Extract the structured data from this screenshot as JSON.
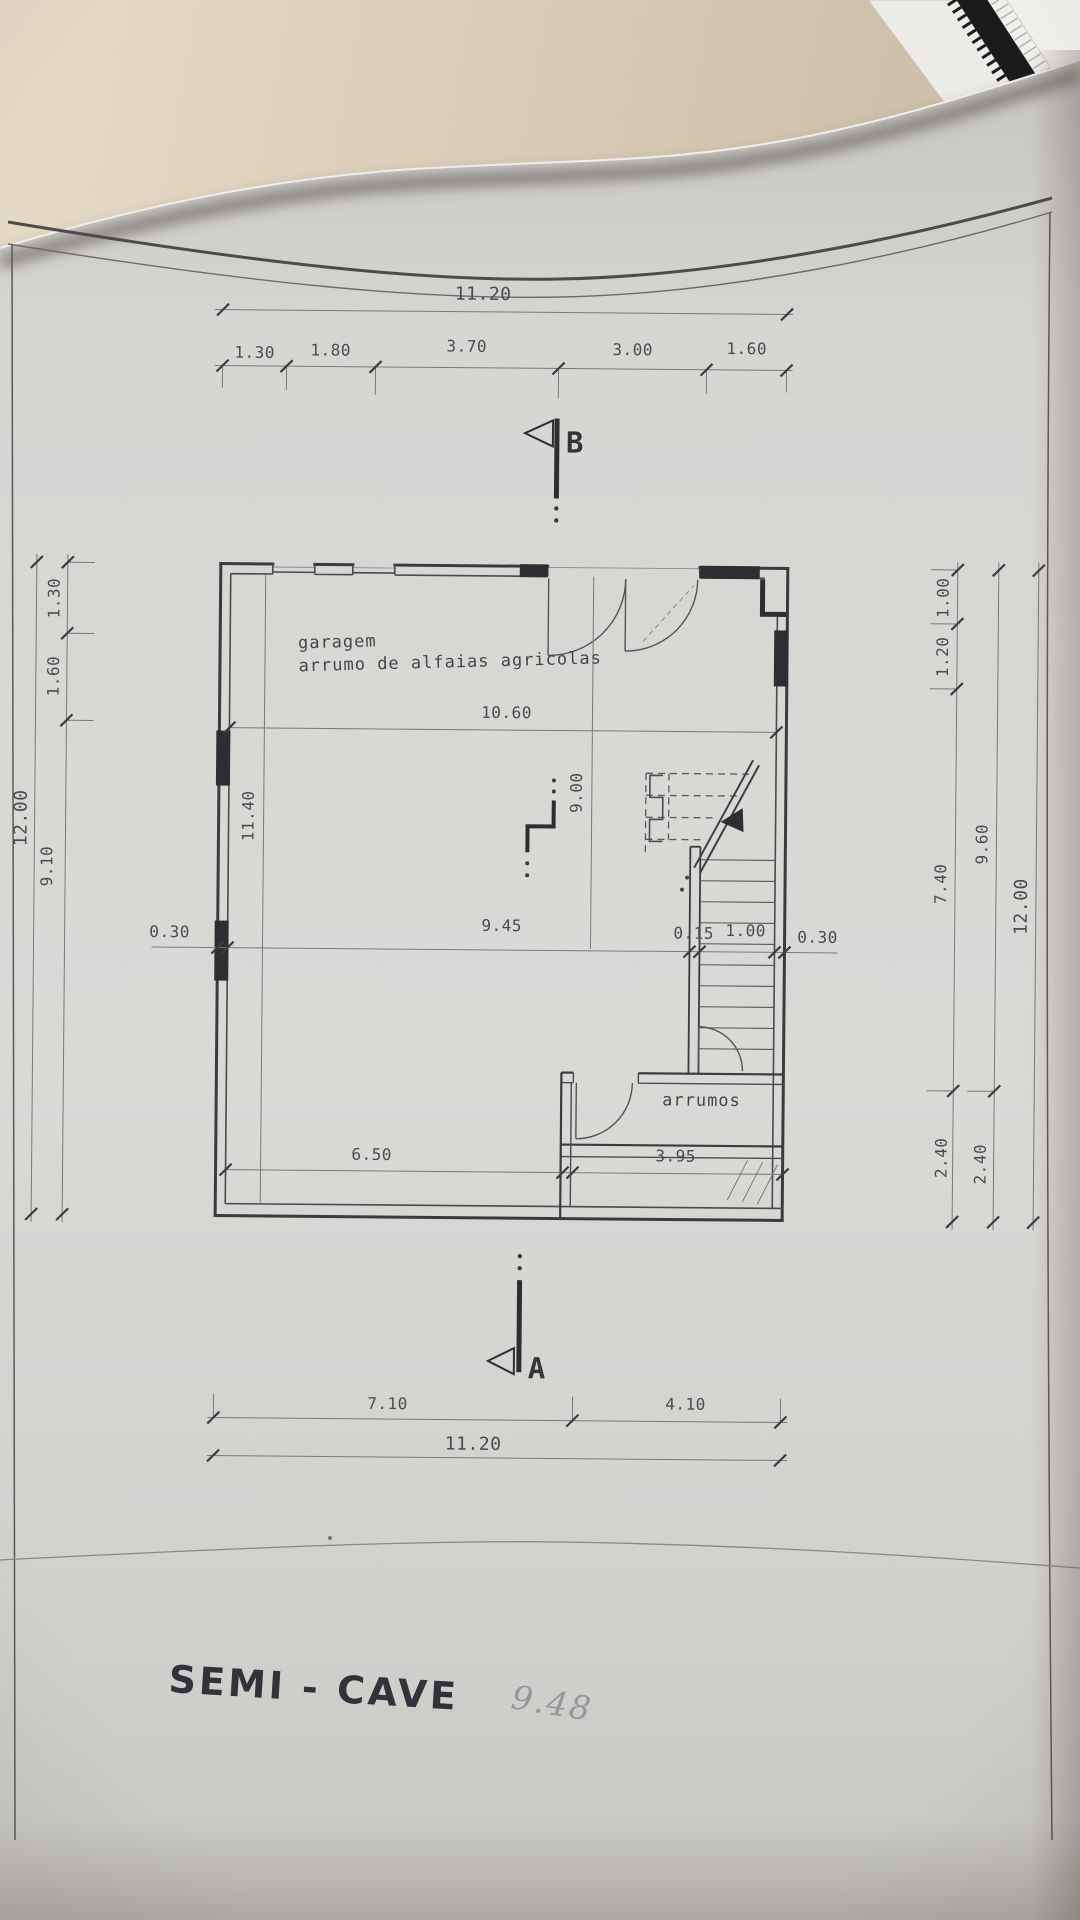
{
  "drawing": {
    "title": "SEMI - CAVE",
    "handwritten_note": "9.48",
    "rooms": {
      "garage_label_line1": "garagem",
      "garage_label_line2": "arrumo de alfaias agricolas",
      "storage_label": "arrumos"
    },
    "section_markers": {
      "top": "B",
      "bottom": "A"
    },
    "dims": {
      "top_overall": "11.20",
      "top_chain": [
        "1.30",
        "1.80",
        "3.70",
        "3.00",
        "1.60"
      ],
      "bottom_chain": [
        "7.10",
        "4.10"
      ],
      "bottom_overall": "11.20",
      "left_overall": "12.00",
      "left_chain": [
        "1.30",
        "1.60",
        "9.10"
      ],
      "right_chain_inner": [
        "1.00",
        "1.20",
        "7.40",
        "2.40"
      ],
      "right_chain_outer": [
        "9.60",
        "2.40"
      ],
      "right_overall": "12.00",
      "interior_width_top": "10.60",
      "interior_width_mid": "9.45",
      "wall_left": "0.30",
      "stair_wall": "0.15",
      "stair_width": "1.00",
      "wall_right": "0.30",
      "interior_height_left": "11.40",
      "interior_height_mid": "9.00",
      "bottom_left_width": "6.50",
      "bottom_right_width": "3.95"
    }
  }
}
